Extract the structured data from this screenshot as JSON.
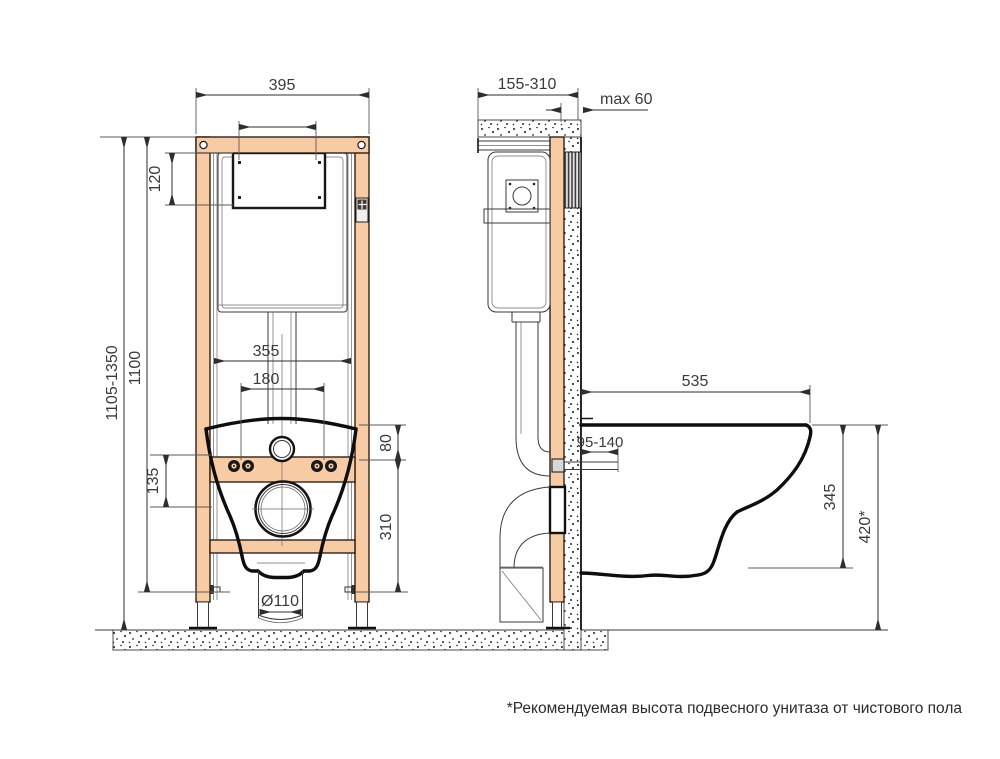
{
  "title": "wall-hung-toilet-installation-frame-drawing",
  "colors": {
    "frame_profile": "#f7cba3",
    "outline": "#0e0e0e",
    "dimension_lines": "#2e2e2e",
    "background": "#ffffff"
  },
  "dims": {
    "front_width": "395",
    "plate_opening_height": "120",
    "total_height_range": "1105-1350",
    "frame_height": "1100",
    "inner_width": "355",
    "bolt_spacing": "180",
    "top_to_bolts": "80",
    "bolts_to_drain": "135",
    "drain_center_height": "310",
    "drain_diameter": "Ø110",
    "depth_range": "155-310",
    "finish_thickness": "max 60",
    "bowl_depth": "535",
    "stud_protrusion": "95-140",
    "bowl_underside_height": "345",
    "bowl_top_height": "420*"
  },
  "footnote": "*Рекомендуемая высота подвесного унитаза от чистового пола"
}
